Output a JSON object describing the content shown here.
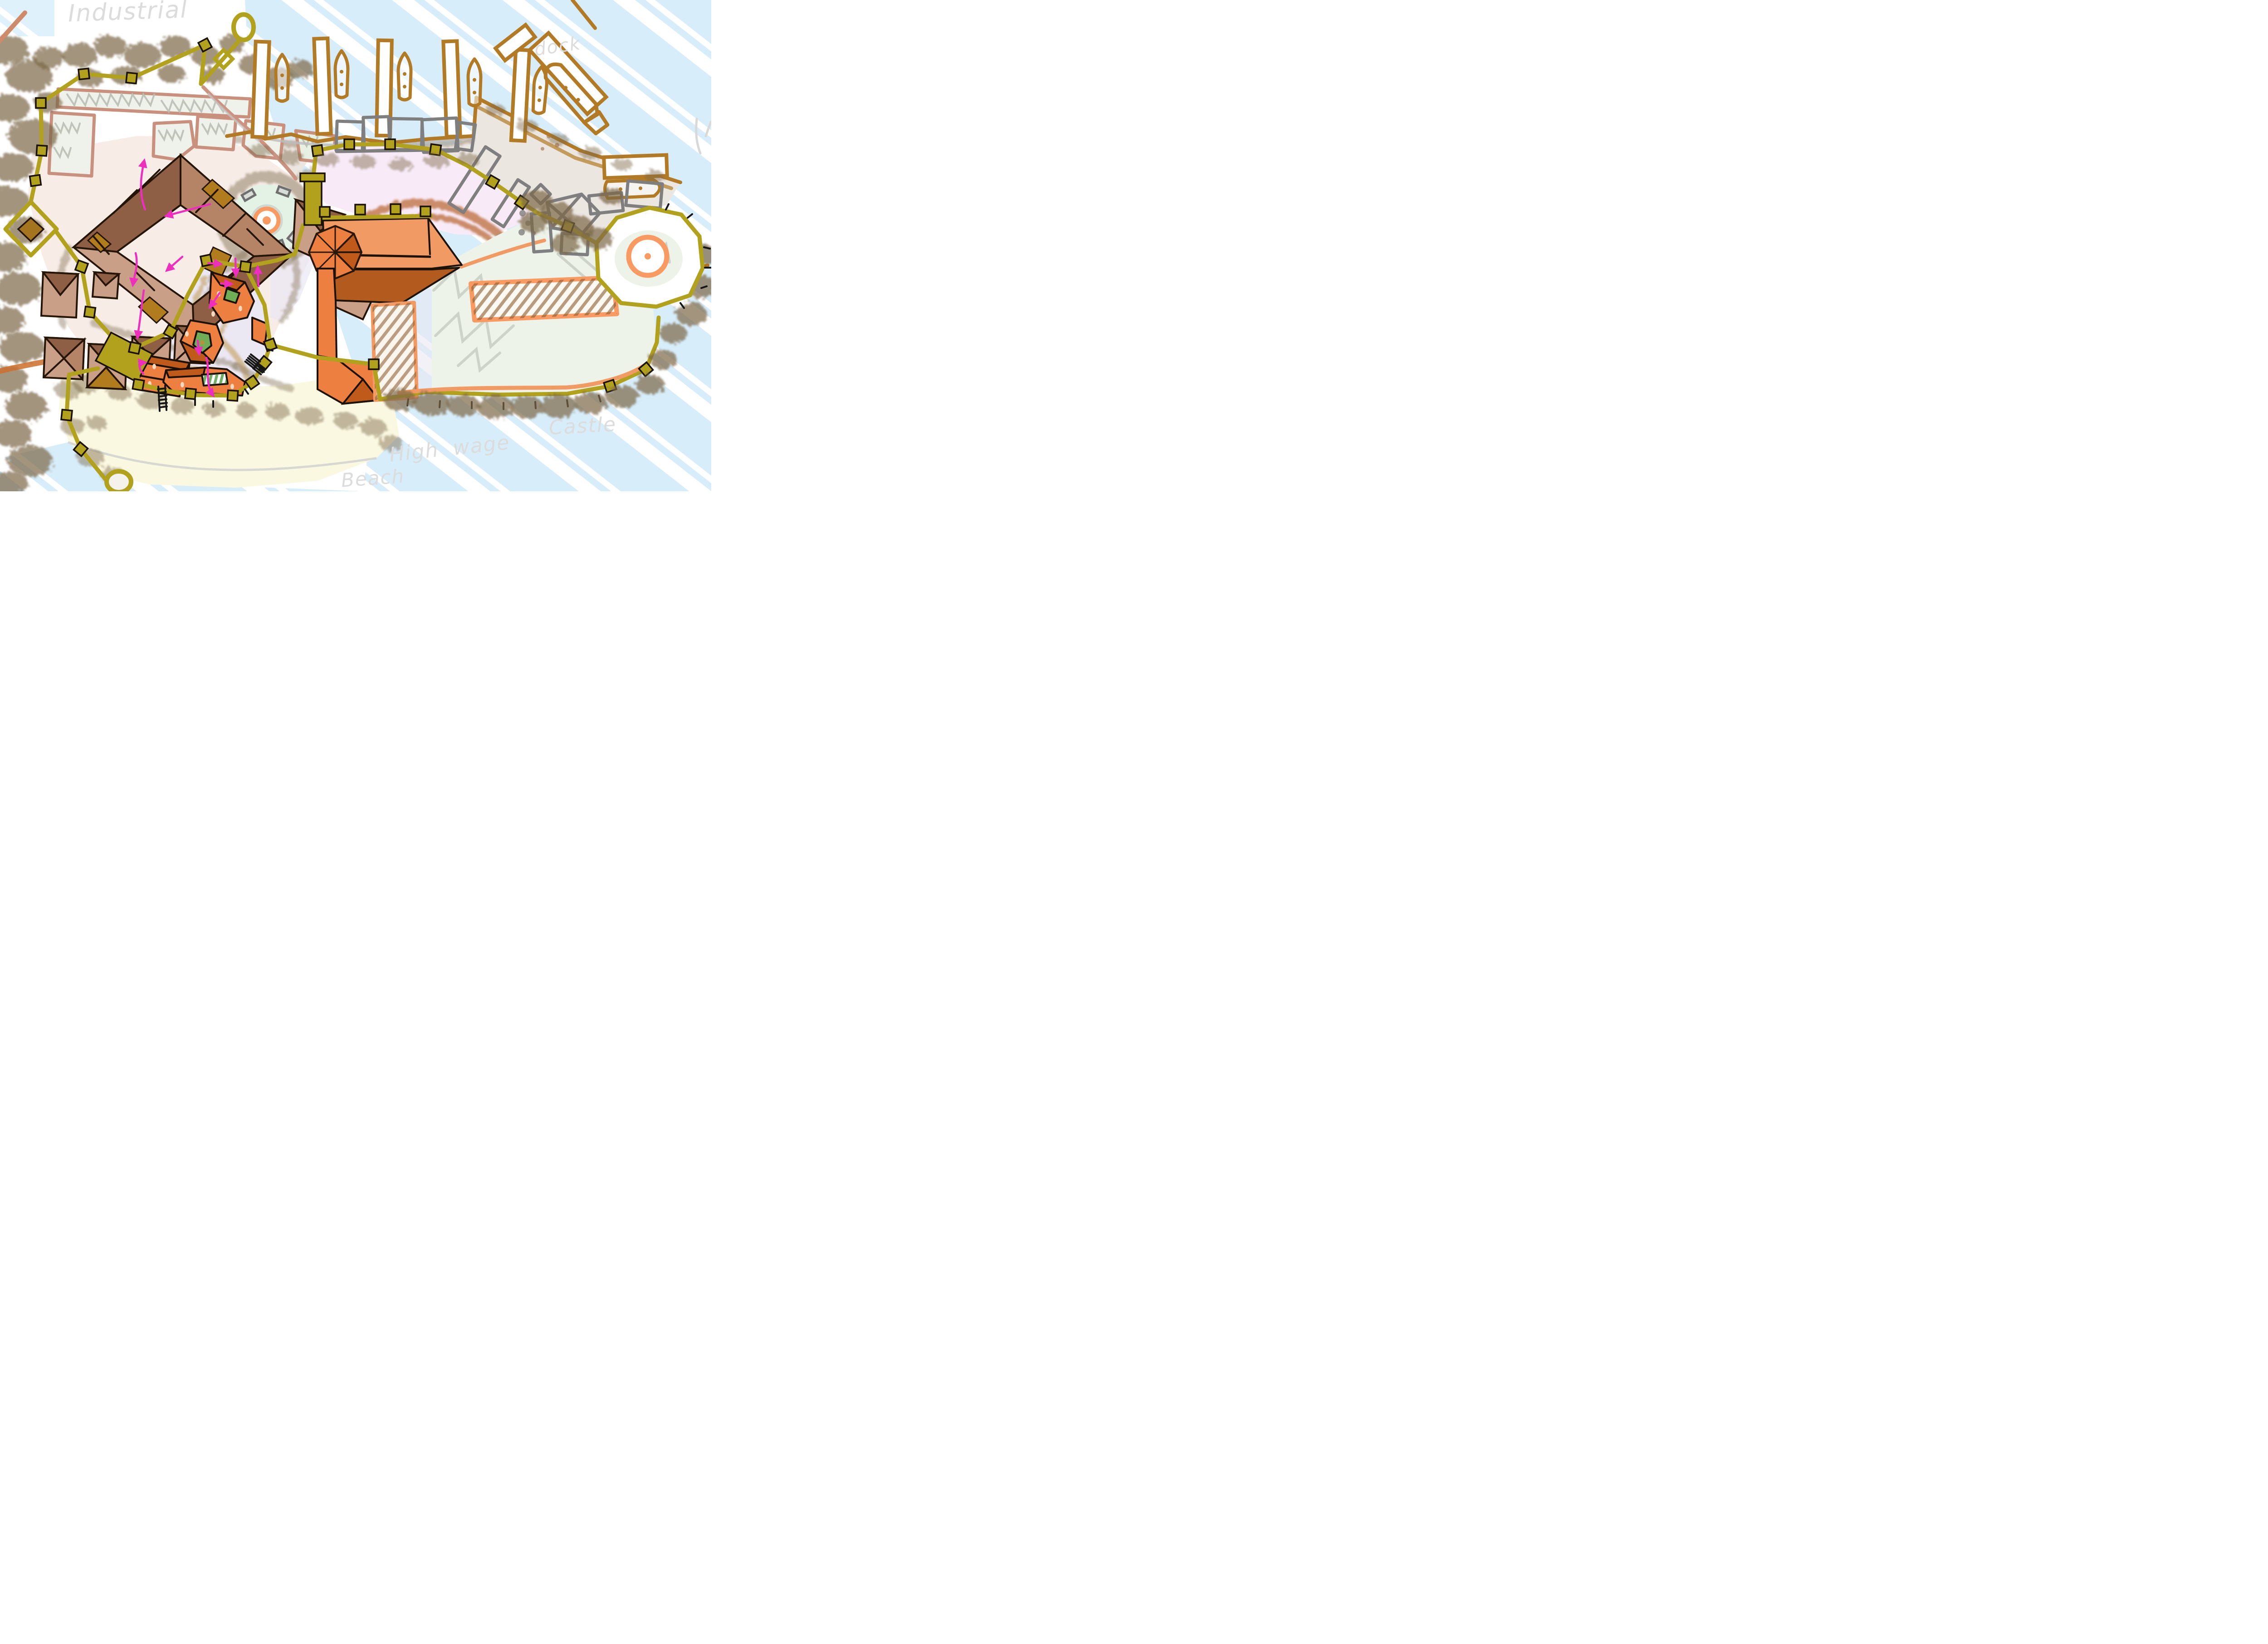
{
  "artwork": {
    "type": "hand-drawn city district planning sketch",
    "labels": {
      "industrial": "Industrial",
      "dock": "dock",
      "castle": "Castle",
      "high_wage": "High wage",
      "beach": "Beach"
    },
    "regions": [
      "forest",
      "industrial district",
      "dock piers and boats",
      "harbor quay",
      "warehouses",
      "old town",
      "central plaza with standing stones",
      "arena field with arcs",
      "walled orange quarter",
      "castle keep",
      "castle courtyard",
      "castle grounds",
      "east round bastion",
      "beach",
      "water",
      "city walls with towers and gates"
    ],
    "colors": {
      "water": "#d7edfa",
      "paper": "#ffffff",
      "beach": "#fbf8e2",
      "forest": "#7b6747",
      "city_wall": "#b1a11c",
      "old_town_walls": "#c99f87",
      "old_town_roofs": "#8f5f45",
      "gold_accents": "#b07c1e",
      "orange_buildings": "#ed8040",
      "orange_roofs": "#c05a1a",
      "castle_roof_light": "#f29a63",
      "castle_roof_dark": "#b35a1e",
      "pink_field": "#f8eaf6",
      "arena_arcs": "#bf7446",
      "warehouse_outline": "#7f7f7f",
      "dock_outline": "#b27a24",
      "industrial_outline": "#c9907e",
      "courtyard_green": "#6fae57",
      "route_arrows": "#ee2ebd",
      "handwriting": "#dcdcdc"
    },
    "annotations": {
      "route_arrow_color": "#ee2ebd",
      "route_arrow_count": 13,
      "stair_symbols": 3,
      "handwriting_color": "#dcdcdc"
    }
  }
}
